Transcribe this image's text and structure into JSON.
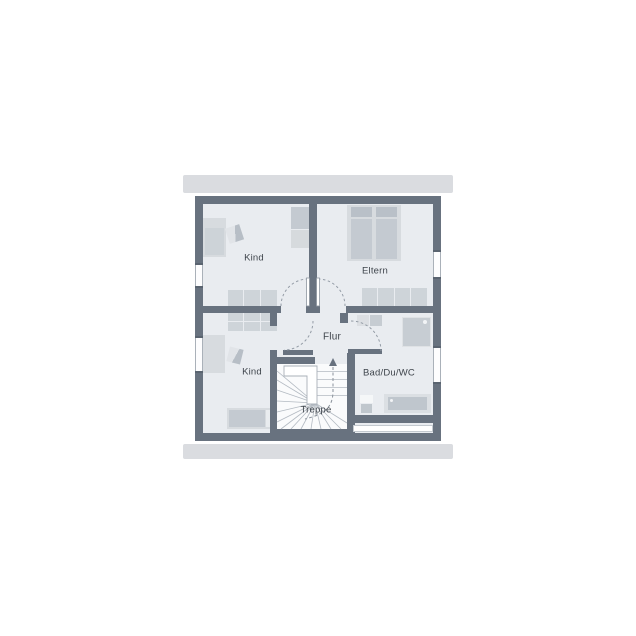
{
  "floor_plan": {
    "type": "residential-upper-floor-plan",
    "rooms": {
      "kind_top": {
        "label": "Kind",
        "furniture": [
          "bed",
          "chair",
          "wardrobe",
          "wardrobe-row"
        ]
      },
      "eltern": {
        "label": "Eltern",
        "furniture": [
          "double-bed",
          "wardrobe-row"
        ]
      },
      "kind_bottom": {
        "label": "Kind",
        "furniture": [
          "wardrobe-grid",
          "desk",
          "chair",
          "bed"
        ]
      },
      "flur": {
        "label": "Flur",
        "furniture": []
      },
      "treppe": {
        "label": "Treppe",
        "furniture": [
          "winder-staircase"
        ]
      },
      "bad": {
        "label": "Bad/Du/WC",
        "furniture": [
          "washbasin",
          "shower",
          "wc",
          "bathtub"
        ]
      }
    },
    "icons": {
      "stair_direction_arrow": "up-arrow"
    },
    "colors": {
      "wall": "#68727f",
      "floor": "#e9ecf0",
      "stair_floor": "#fafbfc",
      "roof_edge_bar": "#dadce0",
      "furniture": "#ced4d9",
      "furniture_dark": "#c4cad1",
      "pillow": "#b9c0c8",
      "window": "#fdfdfe",
      "door_arc": "#949ca6",
      "label_text": "#3f454c"
    }
  }
}
